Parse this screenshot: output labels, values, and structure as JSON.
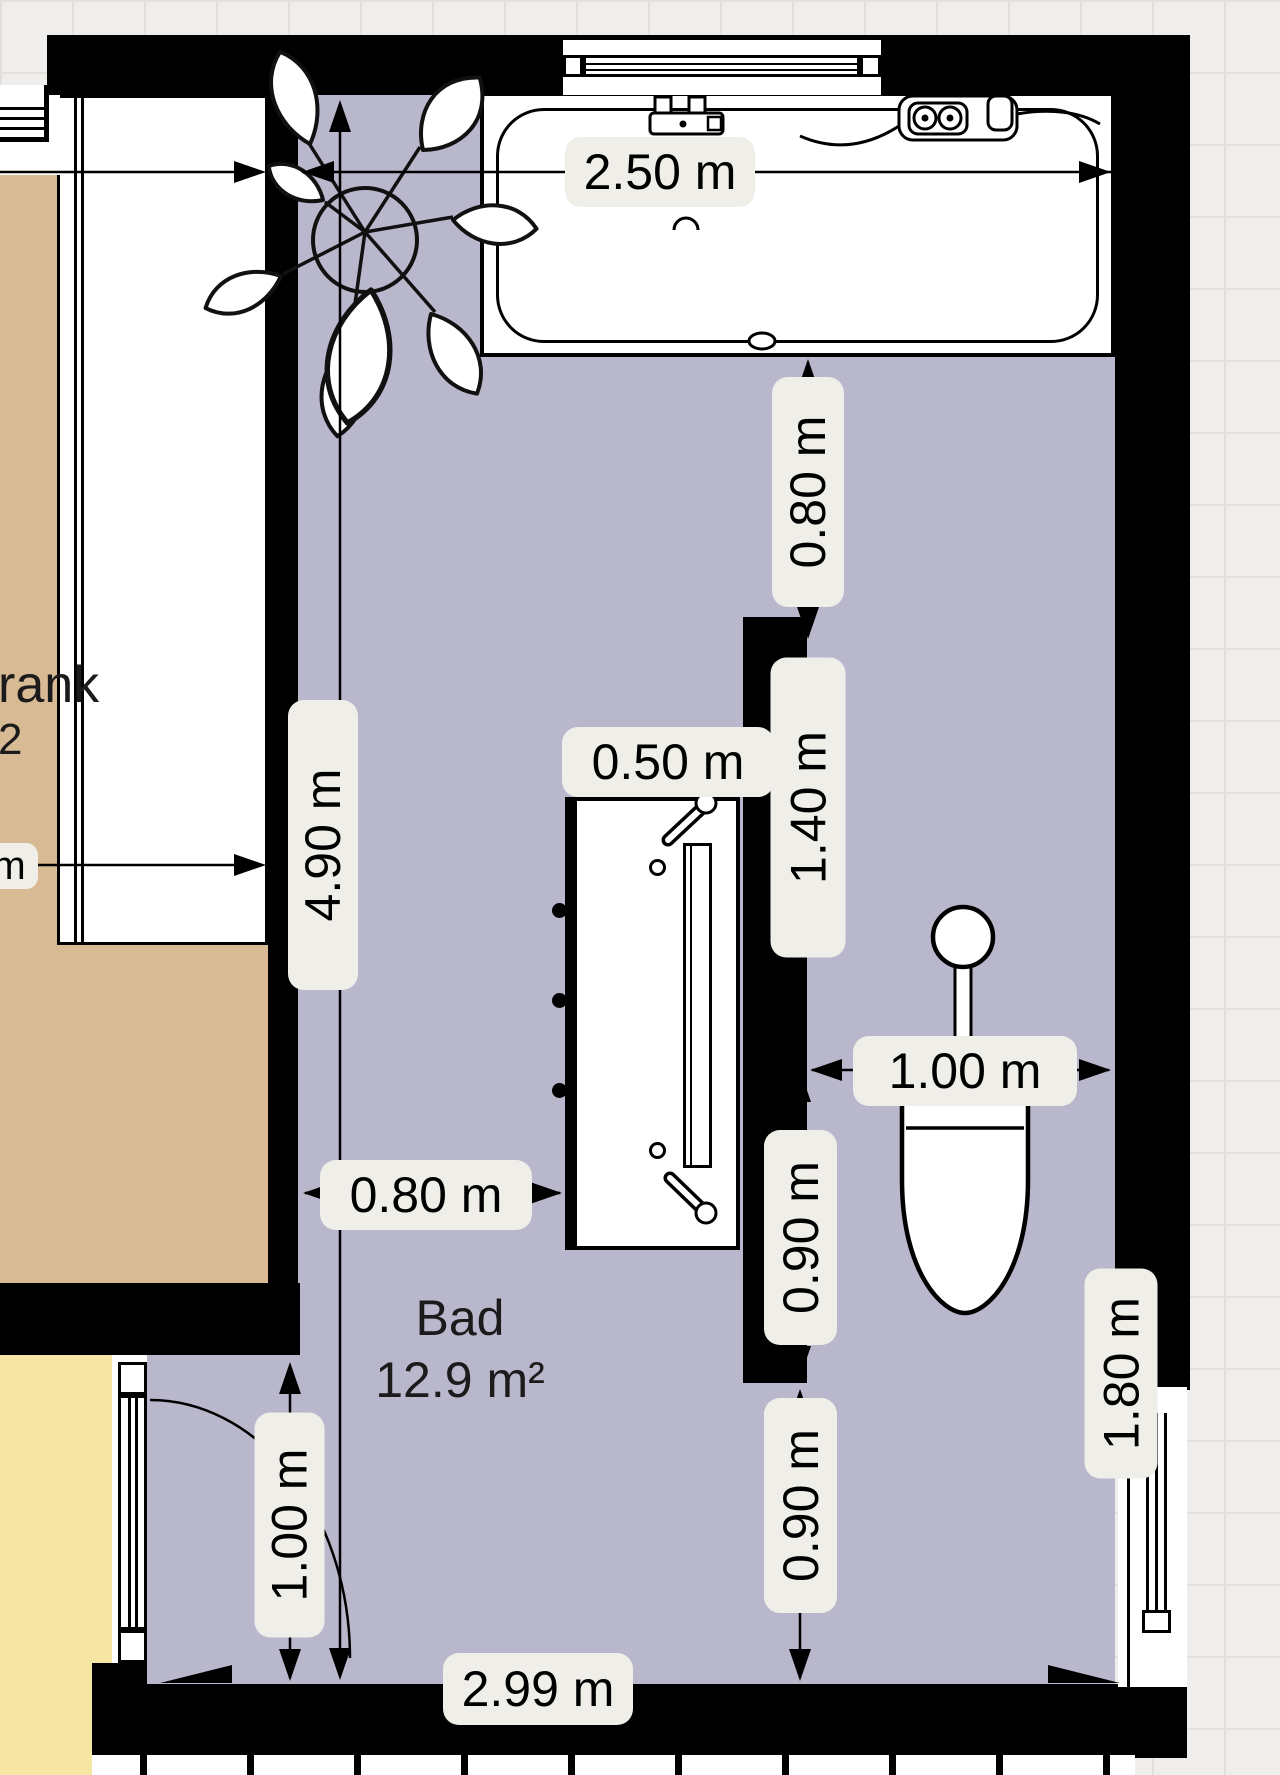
{
  "meta": {
    "app": "floor-planner",
    "view": "bathroom-plan"
  },
  "colors": {
    "wall": "#000000",
    "floor": "#b9b7cc",
    "tan": "#d8ba95",
    "yellow": "#f6e6a4",
    "label-bg": "#f0eee8",
    "bg": "#f0eeec",
    "grid": "#e2e0dd",
    "ink": "#1b1b1b"
  },
  "rooms": {
    "bathroom": {
      "name": "Bad",
      "area": "12.9 m²"
    },
    "left_room_partial": {
      "line1": "rank",
      "line2": "2"
    }
  },
  "dimensions": {
    "tub_width": "2.50 m",
    "room_height": "4.90 m",
    "tub_to_partition": "0.80 m",
    "shower_width": "0.50 m",
    "partition_length": "1.40 m",
    "wc_width": "1.00 m",
    "wc_nook_upper": "0.90 m",
    "wc_nook_lower": "0.90 m",
    "door_width": "1.00 m",
    "door_clearance": "0.80 m",
    "window_width": "1.80 m",
    "room_width": "2.99 m",
    "left_partial_unit": "m"
  },
  "fixtures": {
    "bathtub": "bathtub",
    "shower": "shower-enclosure",
    "toilet": "toilet",
    "plant": "potted-plant",
    "door": "door-with-swing",
    "window_top": "window",
    "window_right": "window",
    "window_left_partial": "window",
    "wardrobe": "built-in-wardrobe"
  }
}
